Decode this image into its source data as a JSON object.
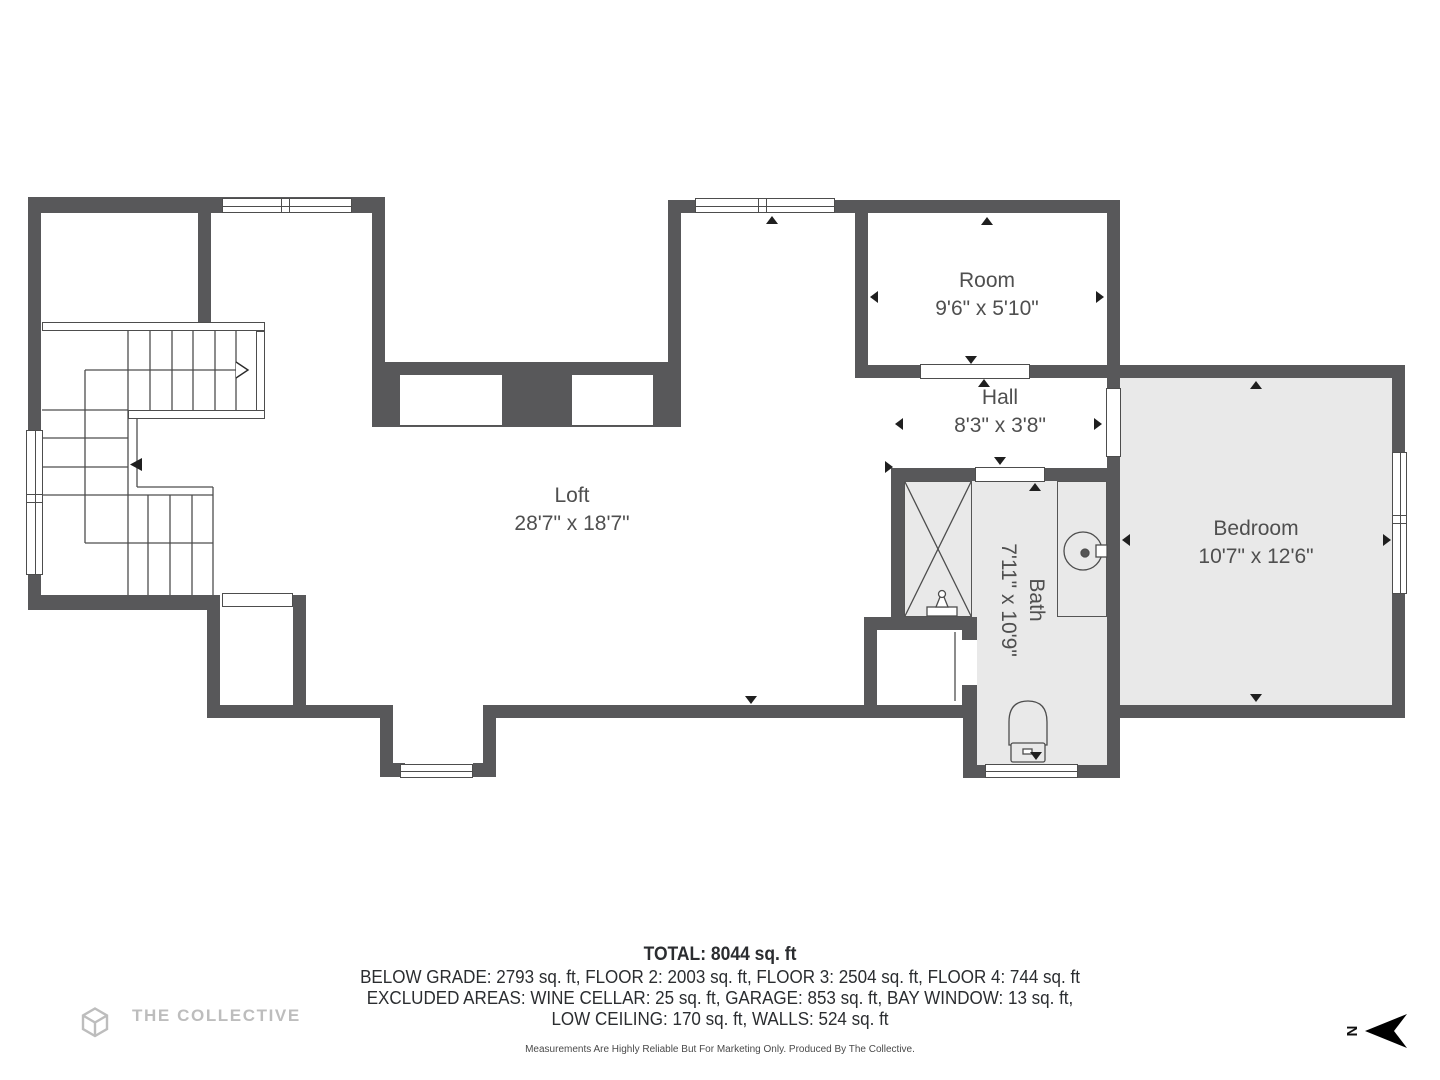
{
  "rooms": {
    "loft": {
      "name": "Loft",
      "dims": "28'7\" x 18'7\""
    },
    "room": {
      "name": "Room",
      "dims": "9'6\" x 5'10\""
    },
    "hall": {
      "name": "Hall",
      "dims": "8'3\" x 3'8\""
    },
    "bath": {
      "name": "Bath",
      "dims": "7'11\" x 10'9\""
    },
    "bedroom": {
      "name": "Bedroom",
      "dims": "10'7\" x 12'6\""
    }
  },
  "summary": {
    "total": "TOTAL: 8044 sq. ft",
    "line1": "BELOW GRADE: 2793 sq. ft, FLOOR 2: 2003 sq. ft, FLOOR 3: 2504 sq. ft, FLOOR 4: 744 sq. ft",
    "line2": "EXCLUDED AREAS: WINE CELLAR: 25 sq. ft, GARAGE: 853 sq. ft, BAY WINDOW: 13 sq. ft,",
    "line3": "LOW CEILING: 170 sq. ft, WALLS: 524 sq. ft",
    "disclaimer": "Measurements Are Highly Reliable But For Marketing Only. Produced By The Collective."
  },
  "branding": {
    "logo_text": "THE COLLECTIVE"
  },
  "compass": {
    "label": "N"
  },
  "colors": {
    "wall": "#58585a",
    "room_fill": "#e9e9e9",
    "line": "#4d4d4d",
    "label_text": "#4f4f4f",
    "logo_gray": "#bdbdbd"
  }
}
